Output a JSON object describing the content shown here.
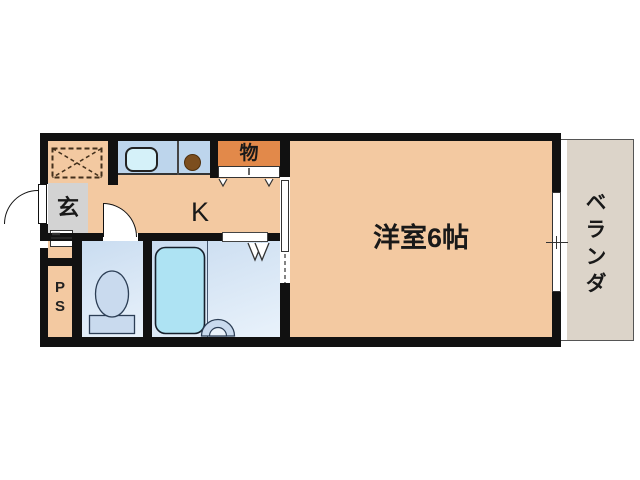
{
  "plan": {
    "type": "floor-plan",
    "rooms": {
      "entrance": {
        "label": "玄"
      },
      "kitchen": {
        "label": "K"
      },
      "closet": {
        "label": "物"
      },
      "western_room": {
        "label": "洋室6帖"
      },
      "veranda": {
        "label": "ベランダ"
      },
      "pipe_space": {
        "letters": [
          "P",
          "S"
        ]
      }
    },
    "colors": {
      "wall": "#111111",
      "room_floor": "#f3c9a1",
      "closet_fill": "#e2894a",
      "entrance_fill": "#d3d3d3",
      "veranda_fill": "#dcd4c9",
      "counter_fill": "#bdd5ec",
      "sink_fill": "#d5f1f9",
      "burner_fill": "#7c4e1e",
      "wet_room_fill": "#d3e2f3",
      "fixture_fill": "#c9daee",
      "bathtub_fill": "#aee3f3",
      "background": "#ffffff"
    }
  }
}
